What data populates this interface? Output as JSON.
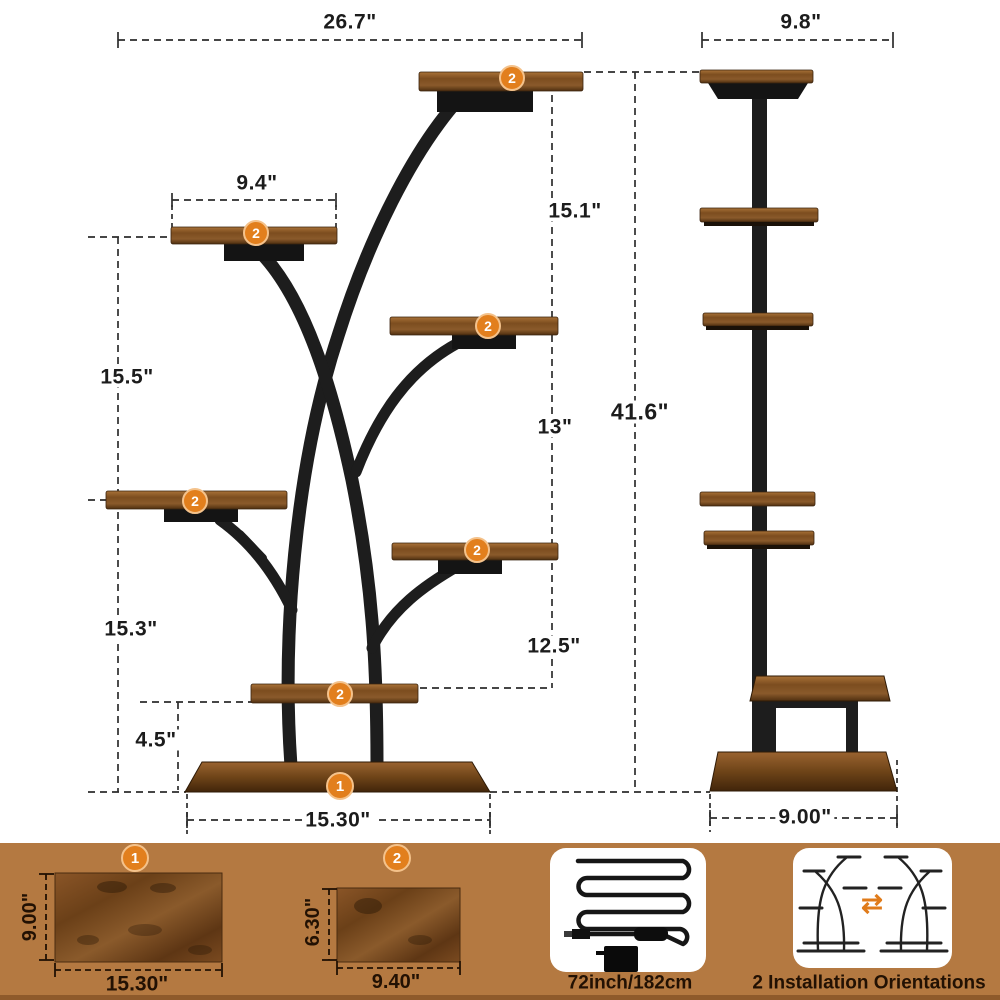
{
  "front_view": {
    "dim_top_width": "26.7\"",
    "dim_shelf_width": "9.4\"",
    "dim_right_upper": "15.1\"",
    "dim_left_upper": "15.5\"",
    "dim_right_mid": "13\"",
    "dim_total_height": "41.6\"",
    "dim_left_lower": "15.3\"",
    "dim_right_lower": "12.5\"",
    "dim_base_height": "4.5\"",
    "dim_base_width": "15.30\"",
    "shelf_badge": "2",
    "base_badge": "1"
  },
  "side_view": {
    "dim_top_width": "9.8\"",
    "dim_base_width": "9.00\""
  },
  "legend": {
    "board_large": {
      "badge": "1",
      "width": "15.30\"",
      "height": "9.00\""
    },
    "board_small": {
      "badge": "2",
      "width": "9.40\"",
      "height": "6.30\""
    },
    "cable": {
      "label": "72inch/182cm"
    },
    "orientations": {
      "label": "2 Installation Orientations",
      "swap_icon": "⇄"
    }
  },
  "colors": {
    "accent_orange": "#E27F1D",
    "band_brown": "#B47941",
    "wood_dark": "#6B4018",
    "metal_black": "#1D1D1D"
  }
}
